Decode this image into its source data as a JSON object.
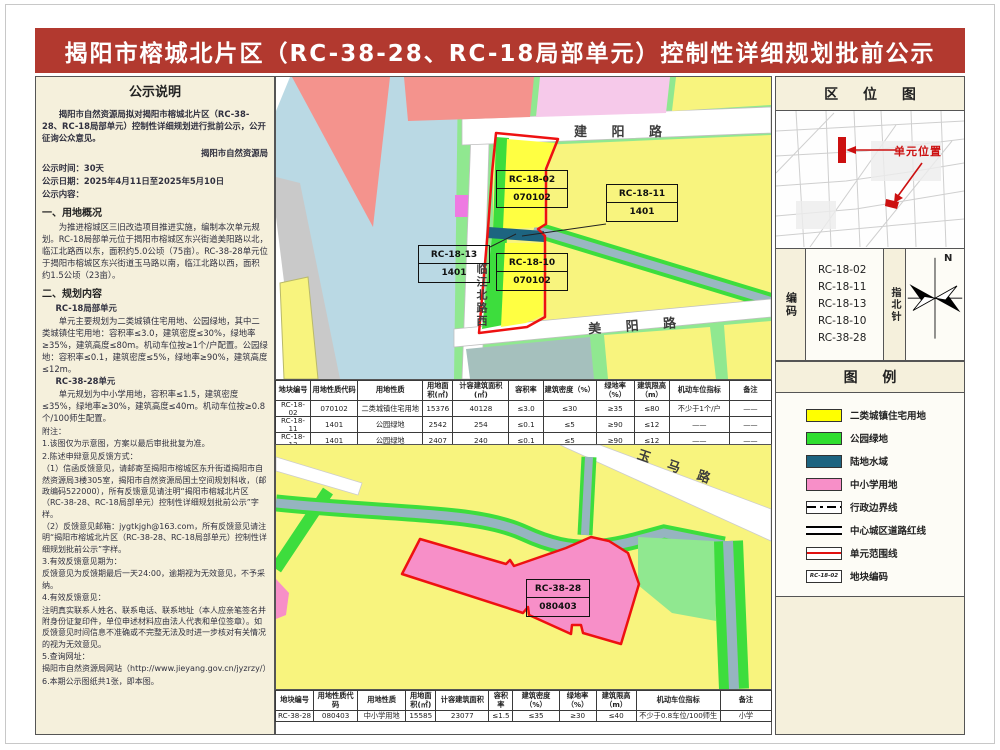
{
  "title": "揭阳市榕城北片区（RC-38-28、RC-18局部单元）控制性详细规划批前公示",
  "notice": {
    "lines": [
      {
        "t": "公示说明",
        "c": "head"
      },
      {
        "t": "揭阳市自然资源局拟对揭阳市榕城北片区（RC-38-28、RC-18局部单元）控制性详细规划进行批前公示，公开征询公众意见。",
        "c": "indb"
      },
      {
        "t": "揭阳市自然资源局",
        "c": "sig"
      },
      {
        "t": "公示时间：30天",
        "c": "b"
      },
      {
        "t": "公示日期：2025年4月11日至2025年5月10日",
        "c": "b"
      },
      {
        "t": "公示内容：",
        "c": "b"
      },
      {
        "t": "一、用地概况",
        "c": "h2"
      },
      {
        "t": "为推进榕城区三旧改造项目推进实施，编制本次单元规划。RC-18局部单元位于揭阳市榕城区东兴街道美阳路以北，临江北路西以东，面积约5.0公顷（75亩）。RC-38-28单元位于揭阳市榕城区东兴街道玉马路以南，临江北路以西，面积约1.5公顷（23亩）。",
        "c": "ind"
      },
      {
        "t": "二、规划内容",
        "c": "h2"
      },
      {
        "t": "RC-18局部单元",
        "c": "sub"
      },
      {
        "t": "单元主要规划为二类城镇住宅用地、公园绿地，其中二类城镇住宅用地：容积率≤3.0，建筑密度≤30%，绿地率≥35%，建筑高度≤80m。机动车位按≥1个/户配置。公园绿地：容积率≤0.1，建筑密度≤5%，绿地率≥90%，建筑高度≤12m。",
        "c": "ind"
      },
      {
        "t": "RC-38-28单元",
        "c": "sub"
      },
      {
        "t": "单元规划为中小学用地，容积率≤1.5，建筑密度≤35%，绿地率≥30%，建筑高度≤40m。机动车位按≥0.8个/100师生配置。",
        "c": "ind"
      },
      {
        "t": "附注：",
        "c": "plain"
      },
      {
        "t": "1.该图仅为示意图，方案以最后审批批复为准。",
        "c": "plain"
      },
      {
        "t": "2.陈述申辩意见反馈方式：",
        "c": "plain"
      },
      {
        "t": "（1）信函反馈意见，请邮寄至揭阳市榕城区东升街道揭阳市自然资源局3楼305室，揭阳市自然资源局国土空间规划科收，（邮政编码522000），所有反馈意见请注明“揭阳市榕城北片区（RC-38-28、RC-18局部单元）控制性详细规划批前公示”字样。",
        "c": "plain"
      },
      {
        "t": "（2）反馈意见邮箱：jygtkjgh@163.com，所有反馈意见请注明“揭阳市榕城北片区（RC-38-28、RC-18局部单元）控制性详细规划批前公示”字样。",
        "c": "plain"
      },
      {
        "t": "3.有效反馈意见期为：",
        "c": "plain"
      },
      {
        "t": "反馈意见为反馈期最后一天24:00，逾期视为无效意见，不予采纳。",
        "c": "plain"
      },
      {
        "t": "4.有效反馈意见：",
        "c": "plain"
      },
      {
        "t": "注明真实联系人姓名、联系电话、联系地址（本人应亲笔签名并附身份证复印件，单位申述材料应由法人代表和单位签章）。如反馈意见时间信息不准确或不完整无法及时进一步核对有关情况的视为无效意见。",
        "c": "plain"
      },
      {
        "t": "5.查询网址：",
        "c": "plain"
      },
      {
        "t": "揭阳市自然资源局网站（http://www.jieyang.gov.cn/jyzrzy/）",
        "c": "plain"
      },
      {
        "t": "6.本期公示图纸共1张，即本图。",
        "c": "plain"
      }
    ]
  },
  "map1": {
    "roads": {
      "jianyang": "建 阳 路",
      "meiyang": "美 阳 路",
      "linjiang": "临江北路西"
    },
    "labels": [
      {
        "code": "RC-18-02",
        "num": "070102"
      },
      {
        "code": "RC-18-11",
        "num": "1401"
      },
      {
        "code": "RC-18-13",
        "num": "1401"
      },
      {
        "code": "RC-18-10",
        "num": "070102"
      }
    ]
  },
  "map2": {
    "road": "玉 马 路",
    "label": {
      "code": "RC-38-28",
      "num": "080403"
    }
  },
  "table1": {
    "headers": [
      "地块编号",
      "用地性质代码",
      "用地性质",
      "用地面积(㎡)",
      "计容建筑面积(㎡)",
      "容积率",
      "建筑密度（%）",
      "绿地率（%）",
      "建筑限高（m）",
      "机动车位指标",
      "备注"
    ],
    "rows": [
      [
        "RC-18-02",
        "070102",
        "二类城镇住宅用地",
        "15376",
        "40128",
        "≤3.0",
        "≤30",
        "≥35",
        "≤80",
        "不少于1个/户",
        "——"
      ],
      [
        "RC-18-11",
        "1401",
        "公园绿地",
        "2542",
        "254",
        "≤0.1",
        "≤5",
        "≥90",
        "≤12",
        "——",
        "——"
      ],
      [
        "RC-18-13",
        "1401",
        "公园绿地",
        "2407",
        "240",
        "≤0.1",
        "≤5",
        "≥90",
        "≤12",
        "——",
        "——"
      ],
      [
        "RC-18-10",
        "070102",
        "二类城镇住宅用地",
        "16835",
        "50505",
        "≤3.0",
        "≤30",
        "≥35",
        "≤80",
        "不少于1个/户",
        "——"
      ]
    ]
  },
  "table2": {
    "headers": [
      "地块编号",
      "用地性质代码",
      "用地性质",
      "用地面积(㎡)",
      "计容建筑面积",
      "容积率",
      "建筑密度（%）",
      "绿地率（%）",
      "建筑限高（m）",
      "机动车位指标",
      "备注"
    ],
    "rows": [
      [
        "RC-38-28",
        "080403",
        "中小学用地",
        "15585",
        "23077",
        "≤1.5",
        "≤35",
        "≥30",
        "≤40",
        "不少于0.8车位/100师生",
        "小学"
      ]
    ]
  },
  "sidebar": {
    "location_title": "区 位 图",
    "unit_location_label": "单元位置",
    "codes_label": "编码",
    "codes": [
      "RC-18-02",
      "RC-18-11",
      "RC-18-13",
      "RC-18-10",
      "RC-38-28"
    ],
    "compass_label": "指北针",
    "compass_n": "N",
    "legend_title": "图 例",
    "legend": [
      {
        "label": "二类城镇住宅用地",
        "kind": "swatch",
        "color": "#ffff00"
      },
      {
        "label": "公园绿地",
        "kind": "swatch",
        "color": "#2fde2f"
      },
      {
        "label": "陆地水域",
        "kind": "swatch",
        "color": "#1d6480"
      },
      {
        "label": "中小学用地",
        "kind": "swatch",
        "color": "#f78fc8"
      },
      {
        "label": "行政边界线",
        "kind": "dashdot"
      },
      {
        "label": "中心城区道路红线",
        "kind": "doubleline"
      },
      {
        "label": "单元范围线",
        "kind": "redline"
      },
      {
        "label": "地块编码",
        "kind": "codebox",
        "swatch_text": "RC-18-02"
      }
    ]
  },
  "colors": {
    "title_bar": "#b2392f",
    "residential_yellow": "#ffff00",
    "park_green": "#2fde2f",
    "water_teal": "#1d6480",
    "school_pink": "#f78fc8",
    "unit_boundary_red": "#ee1111"
  }
}
